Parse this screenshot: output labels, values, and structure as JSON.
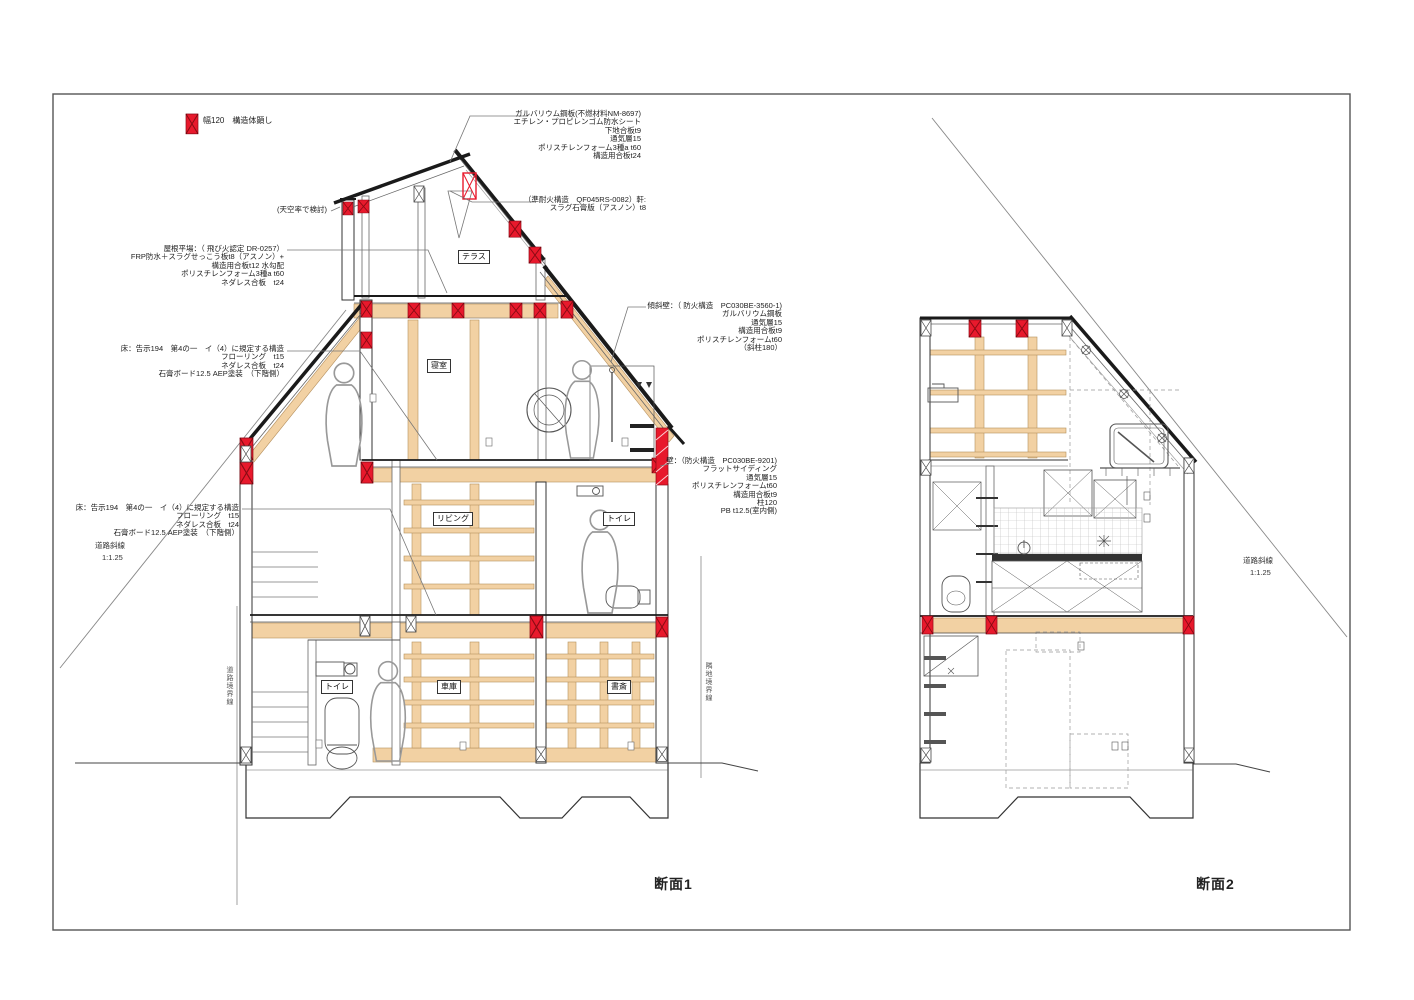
{
  "legend": {
    "marker": "red-x-box",
    "label": "幅120　構造体顕し"
  },
  "titles": {
    "section1": "断面1",
    "section2": "断面2"
  },
  "boundaries": {
    "left": "道路境界線",
    "right": "隣地境界線"
  },
  "regulation": {
    "road_slope_line1": "道路斜線",
    "road_slope_line2": "1:1.25",
    "sky_factor_note": "(天空率で検討)"
  },
  "rooms": {
    "terrace": "テラス",
    "bedroom": "寝室",
    "living": "リビング",
    "toilet2f": "トイレ",
    "toilet1f": "トイレ",
    "garage": "車庫",
    "study": "書斎"
  },
  "annotations": {
    "roof": {
      "lines": [
        "ガルバリウム鋼板(不燃材料NM-8697)",
        "エチレン・プロピレンゴム防水シート",
        "下地合板t9",
        "通気層15",
        "ポリスチレンフォーム3種a t60",
        "構造用合板t24"
      ]
    },
    "eave": {
      "lines": [
        "（準耐火構造　QF045RS-0082）軒:",
        "スラグ石膏版（アスノン）t8"
      ]
    },
    "flat_roof": {
      "lines": [
        "屋根平場：（ 飛び火認定 DR-0257）",
        "FRP防水＋スラグせっこう板t8（アスノン）+",
        "構造用合板t12 水勾配",
        "ポリスチレンフォーム3種a t60",
        "ネダレス合板　t24"
      ]
    },
    "floor_upper": {
      "lines": [
        "床：告示194　第4の一　イ（4）に規定する構造",
        "フローリング　t15",
        "ネダレス合板　t24",
        "石膏ボード12.5 AEP塗装　（下階側）"
      ]
    },
    "floor_lower": {
      "lines": [
        "床：告示194　第4の一　イ（4）に規定する構造",
        "フローリング　t15",
        "ネダレス合板　t24",
        "石膏ボード12.5 AEP塗装　（下階側）"
      ]
    },
    "sloped_wall": {
      "lines": [
        "傾斜壁：（ 防火構造　PC030BE-3560-1)",
        "ガルバリウム鋼板",
        "通気層15",
        "構造用合板t9",
        "ポリスチレンフォームt60",
        "（斜柱180）"
      ]
    },
    "wall": {
      "lines": [
        "壁：（防火構造　PC030BE-9201)",
        "フラットサイディング",
        "通気層15",
        "ポリスチレンフォームt60",
        "構造用合板t9",
        "柱120",
        "PB t12.5(室内側)"
      ]
    }
  },
  "colors": {
    "structure_red": "#e8192c",
    "wood": "#f2d1a3",
    "line": "#333333"
  }
}
